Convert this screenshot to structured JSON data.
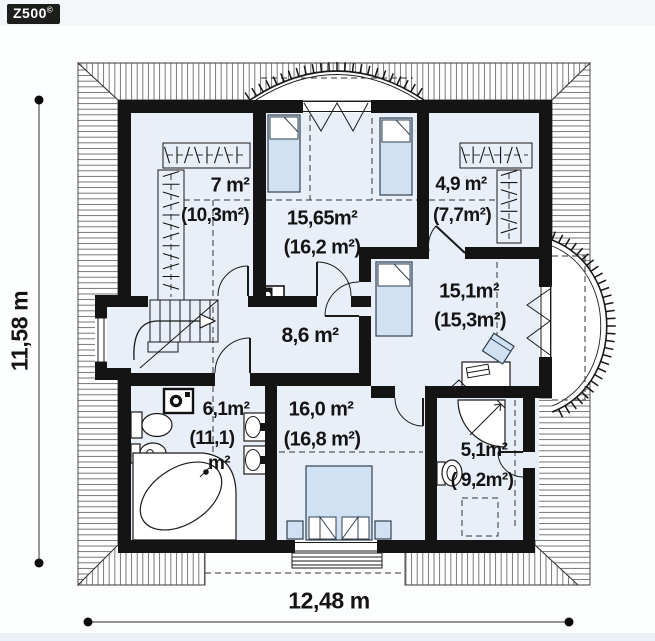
{
  "logo": {
    "brand": "Z500",
    "mark": "©"
  },
  "dimensions": {
    "horizontal": "12,48 m",
    "vertical": "11,58 m"
  },
  "rooms": [
    {
      "name": "wardrobe-left",
      "area_net": "7 m²",
      "area_gross": "(10,3m²)"
    },
    {
      "name": "bedroom-top",
      "area_net": "15,65m²",
      "area_gross": "(16,2 m²)"
    },
    {
      "name": "wardrobe-right",
      "area_net": "4,9 m²",
      "area_gross": "(7,7m²)"
    },
    {
      "name": "room-right",
      "area_net": "15,1m²",
      "area_gross": "(15,3m²)"
    },
    {
      "name": "hall",
      "area_net": "8,6 m²"
    },
    {
      "name": "bathroom-left",
      "area_net": "6,1m²",
      "area_gross": "(11,1)",
      "area_gross_unit": "m²"
    },
    {
      "name": "bedroom-bottom",
      "area_net": "16,0 m²",
      "area_gross": "(16,8 m²)"
    },
    {
      "name": "bathroom-right",
      "area_net": "5,1m²",
      "area_gross": "( 9,2m²)"
    }
  ],
  "colors": {
    "wall": "#141414",
    "floor": "#e9eff8",
    "furniture": "#cfe1f3",
    "logo-bg": "#1d1d1b",
    "text": "#141414"
  }
}
